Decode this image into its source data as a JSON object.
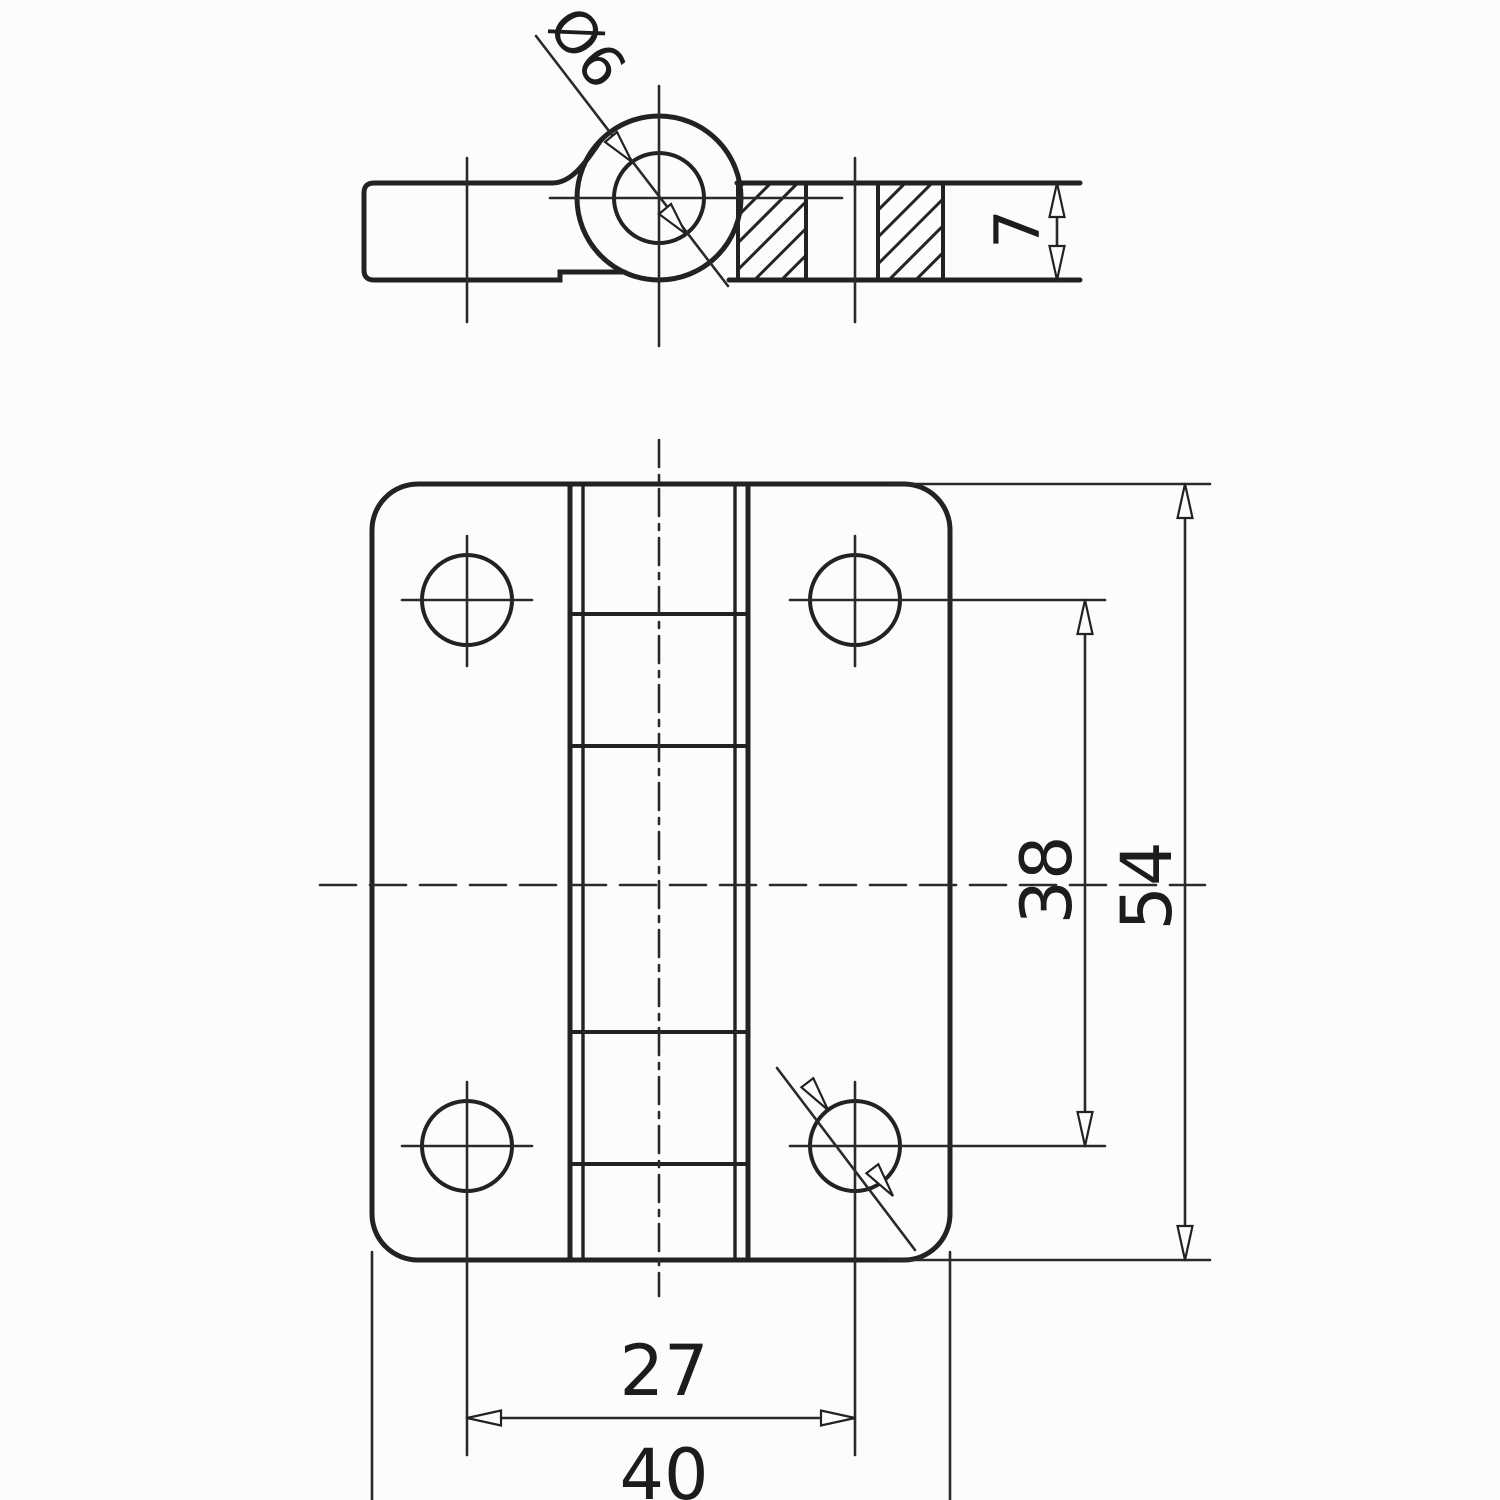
{
  "drawing": {
    "colors": {
      "line": "#222222",
      "background": "#fcfcfa"
    },
    "views": {
      "section": {
        "labels": {
          "pin_hole_diameter": "Ø6",
          "leaf_thickness": "7"
        }
      },
      "front": {
        "labels": {
          "hole_pitch_vertical": "38",
          "overall_height": "54",
          "hole_pitch_horizontal": "27",
          "overall_width": "40"
        }
      }
    }
  }
}
